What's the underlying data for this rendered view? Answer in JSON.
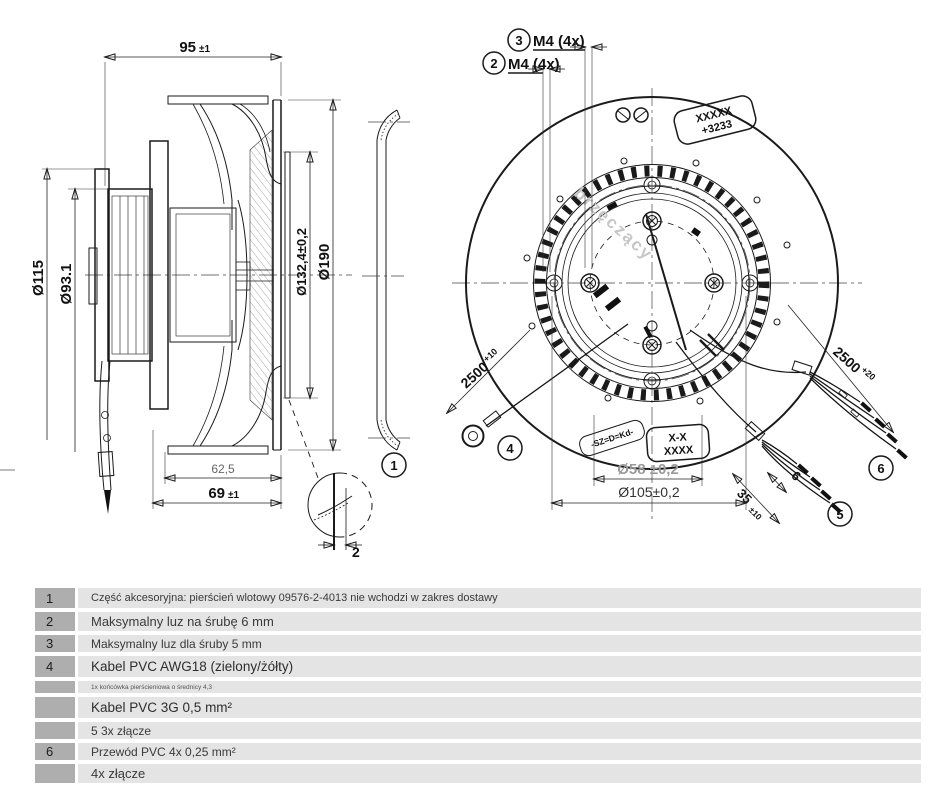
{
  "watermark": "brzęczący",
  "side_view": {
    "dim_width_main": "95",
    "dim_width_tol": "±1",
    "dim_d115": "Ø115",
    "dim_d93": "Ø93.1",
    "dim_d132": "Ø132,4±0,2",
    "dim_d190": "Ø190",
    "dim_base": "62,5",
    "dim_total_main": "69",
    "dim_total_tol": "±1",
    "detail_gap": "2",
    "callout_inlet": "1"
  },
  "front_view": {
    "callout2_num": "2",
    "callout2_label": "M4 (4x)",
    "callout3_num": "3",
    "callout3_label": "M4 (4x)",
    "nameplate_line1": "XXXXX",
    "nameplate_line2": "+3233",
    "marking_stamp": "-SZ=D=Kd-",
    "section_line1": "X-X",
    "section_line2": "XXXX",
    "ground_len": "2500",
    "ground_tol": "+10",
    "cable_len": "2500",
    "cable_tol": "+20",
    "strip_len": "35",
    "strip_tol": "±10",
    "tip_len": "6",
    "dim_d58": "Ø58 ±0,2",
    "dim_d105": "Ø105±0,2",
    "callout4": "4",
    "callout5": "5",
    "callout6": "6"
  },
  "table": {
    "rows": [
      {
        "num": "1",
        "text": "Część akcesoryjna: pierścień wlotowy 09576-2-4013 nie wchodzi w zakres dostawy",
        "variant": "small"
      },
      {
        "num": "2",
        "text": "Maksymalny luz na śrubę 6 mm",
        "variant": "normal"
      },
      {
        "num": "3",
        "text": "Maksymalny luz dla śruby 5 mm",
        "variant": "mid"
      },
      {
        "num": "4",
        "text": "Kabel PVC AWG18 (zielony/żółty)",
        "variant": "large"
      },
      {
        "num": "",
        "text": "1x końcówka pierścieniowa o średnicy 4,3",
        "variant": "tiny"
      },
      {
        "num": "",
        "text": "Kabel PVC 3G 0,5 mm²",
        "variant": "large"
      },
      {
        "num": "",
        "text": "5 3x złącze",
        "variant": "mid"
      },
      {
        "num": "6",
        "text": "Przewód PVC 4x 0,25 mm²",
        "variant": "mid"
      },
      {
        "num": "",
        "text": "4x złącze",
        "variant": "normal"
      }
    ]
  }
}
